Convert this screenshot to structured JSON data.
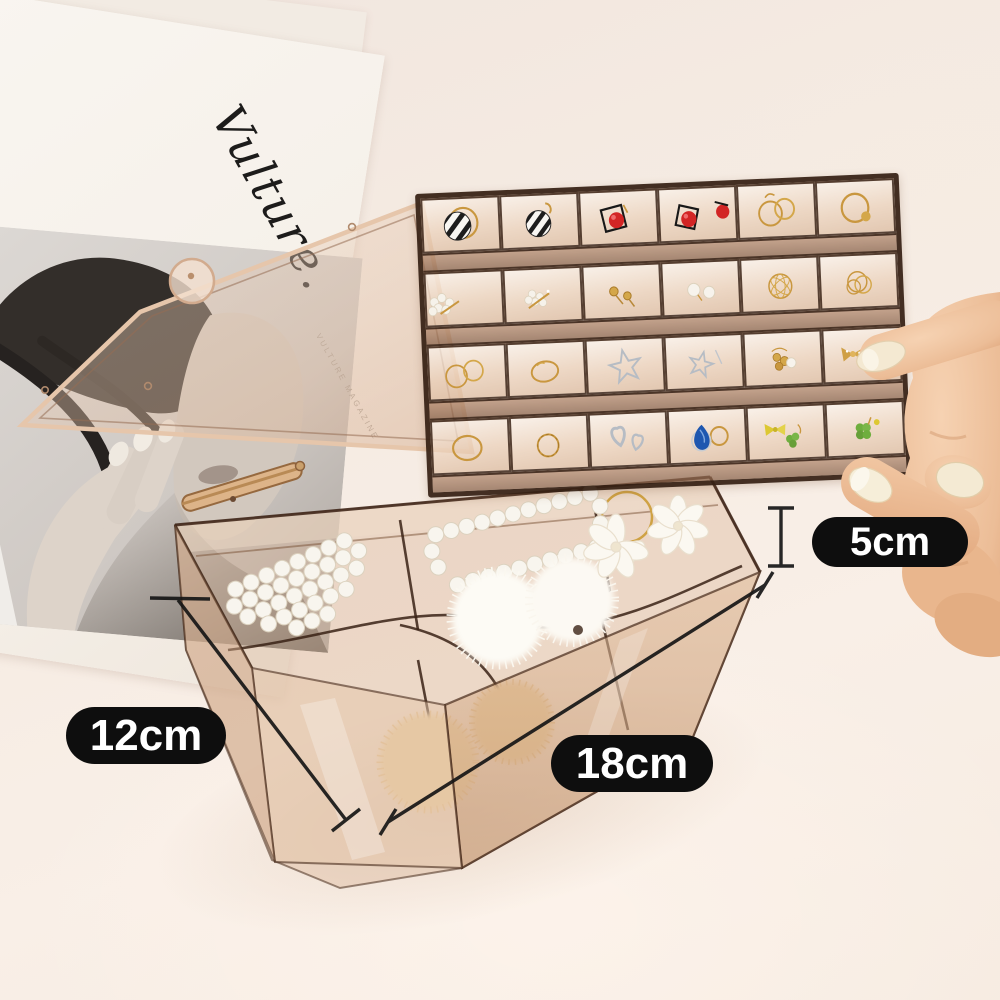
{
  "scene": {
    "type": "product-photo",
    "subject": "transparent amber acrylic jewelry organizer with 24-grid earring tray, bottom compartment box, magazine and hand",
    "background_color": "#f5ebe2"
  },
  "dimension_labels": {
    "height": "5cm",
    "width": "12cm",
    "length": "18cm",
    "badge_bg": "#0e0e0e",
    "badge_text_color": "#ffffff",
    "line_color": "#161616"
  },
  "magazine": {
    "script_title": "Vulture.",
    "side_caption": "VULTURE MAGAZINE",
    "paper_color": "#f7f3ed"
  },
  "organizer": {
    "body_tint": "#cfa27c",
    "frame_color": "#3c2517",
    "tray_grid": {
      "rows": 4,
      "cols": 6
    },
    "tray_items": [
      "black-white striped hoop earring",
      "black-white striped drop earring",
      "red bead square-frame earring",
      "red bead square earring",
      "gold double hoop earrings",
      "gold hoop with ball earring",
      "pearl cluster pin",
      "pearl crystal hair pin",
      "gold stud earrings",
      "pearl stud earrings",
      "gold wire ball earring",
      "gold wire coil earrings",
      "thin gold rings",
      "gold oval ring",
      "silver star earring",
      "silver star drop earring",
      "gold flower cluster studs",
      "gold bow crystal earrings",
      "gold oval hoop",
      "gold twisted ring",
      "silver heart knot earrings",
      "blue crystal teardrop ring",
      "yellow bow and clover earrings",
      "green clover earrings"
    ],
    "box_items": [
      "pearl beaded barrette",
      "pearl frame barrette",
      "pearl flower hair claws",
      "white fur pompom clips",
      "tan fur pompom clips"
    ]
  },
  "hand": {
    "position": "right",
    "skin_tone": "#eec09e"
  }
}
